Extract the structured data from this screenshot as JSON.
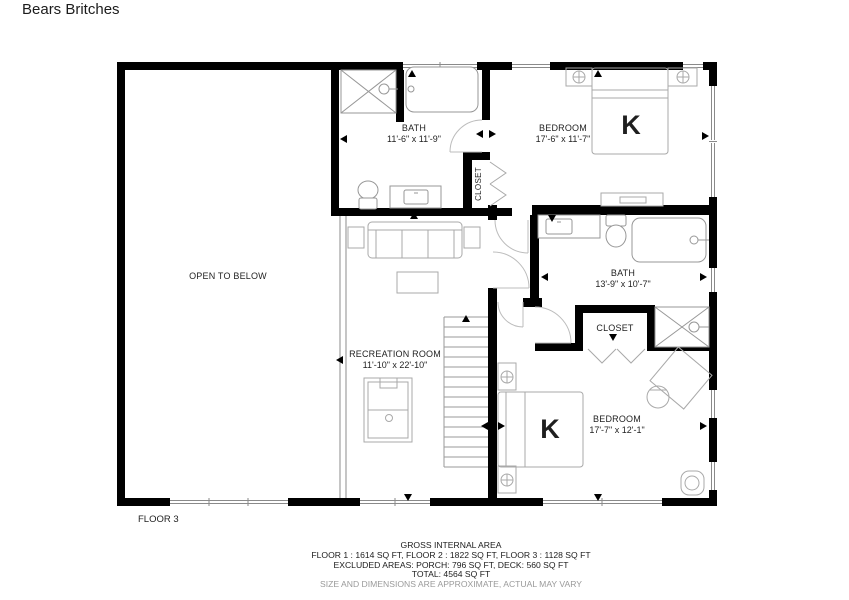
{
  "title": "Bears Britches",
  "floor_label": "FLOOR 3",
  "rooms": {
    "open_to_below": {
      "name": "OPEN TO BELOW"
    },
    "bath1": {
      "name": "BATH",
      "dims": "11'-6\" x 11'-9\""
    },
    "bedroom1": {
      "name": "BEDROOM",
      "dims": "17'-6\" x 11'-7\"",
      "bed": "K"
    },
    "closet1": {
      "name": "CLOSET"
    },
    "bath2": {
      "name": "BATH",
      "dims": "13'-9\" x 10'-7\""
    },
    "closet2": {
      "name": "CLOSET"
    },
    "recreation": {
      "name": "RECREATION ROOM",
      "dims": "11'-10\" x 22'-10\""
    },
    "bedroom2": {
      "name": "BEDROOM",
      "dims": "17'-7\" x 12'-1\"",
      "bed": "K"
    }
  },
  "footer": {
    "line1": "GROSS INTERNAL AREA",
    "line2": "FLOOR 1 : 1614 SQ FT, FLOOR 2 : 1822 SQ FT, FLOOR 3 : 1128 SQ FT",
    "line3": "EXCLUDED AREAS: PORCH: 796 SQ FT, DECK: 560 SQ FT",
    "line4": "TOTAL: 4564 SQ FT",
    "line5": "SIZE AND DIMENSIONS ARE APPROXIMATE, ACTUAL MAY VARY"
  },
  "colors": {
    "wall": "#000000",
    "furniture": "#a9a9a9",
    "muted_text": "#9a9a9a"
  }
}
